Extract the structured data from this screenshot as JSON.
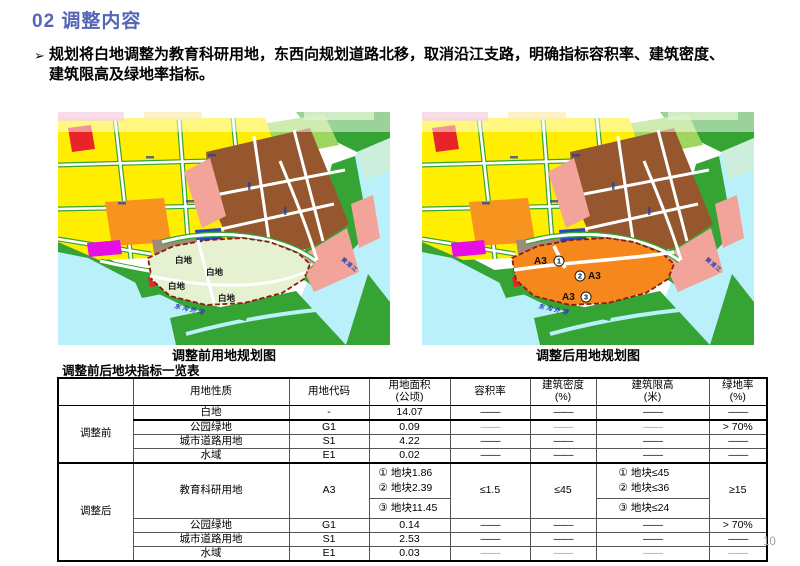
{
  "title": "02 调整内容",
  "bullet": {
    "marker": "➢",
    "lines": [
      "规划将白地调整为教育科研用地，东西向规划道路北移，取消沿江支路，明确指标容积率、建筑密度、",
      "建筑限高及绿地率指标。"
    ]
  },
  "maps": {
    "shared": {
      "river_label": "黄浦江",
      "channel_label": "东沟外港"
    },
    "before": {
      "caption": "调整前用地规划图",
      "area_labels": [
        "白地",
        "白地",
        "白地",
        "白地"
      ]
    },
    "after": {
      "caption": "调整后用地规划图",
      "labels": [
        {
          "code": "A3",
          "num": "1"
        },
        {
          "code": "A3",
          "num": "2"
        },
        {
          "code": "A3",
          "num": "3"
        }
      ]
    }
  },
  "colors": {
    "title_blue": "#5565b7",
    "plan_before_fill": "#e6f1d2",
    "plan_after_fill": "#f6871c",
    "plan_border_red": "#8f1a10",
    "water_cyan": "#b9f0f9",
    "green": "#35a435",
    "yellow": "#ffee00",
    "brown": "#96572e",
    "salmon": "#f2a49b"
  },
  "table": {
    "title": "调整前后地块指标一览表",
    "headers": [
      {
        "l1": "",
        "l2": ""
      },
      {
        "l1": "用地性质",
        "l2": ""
      },
      {
        "l1": "用地代码",
        "l2": ""
      },
      {
        "l1": "用地面积",
        "l2": "(公顷)"
      },
      {
        "l1": "容积率",
        "l2": ""
      },
      {
        "l1": "建筑密度",
        "l2": "(%)"
      },
      {
        "l1": "建筑限高",
        "l2": "(米)"
      },
      {
        "l1": "绿地率",
        "l2": "(%)"
      }
    ],
    "before": {
      "label": "调整前",
      "rows": [
        {
          "nature": "白地",
          "code": "-",
          "area": "14.07",
          "far": "——",
          "density": "——",
          "height": "——",
          "green": "——"
        },
        {
          "nature": "公园绿地",
          "code": "G1",
          "area": "0.09",
          "far": "——",
          "density": "——",
          "height": "——",
          "green": "> 70%"
        },
        {
          "nature": "城市道路用地",
          "code": "S1",
          "area": "4.22",
          "far": "——",
          "density": "——",
          "height": "——",
          "green": "——"
        },
        {
          "nature": "水域",
          "code": "E1",
          "area": "0.02",
          "far": "——",
          "density": "——",
          "height": "——",
          "green": "——"
        }
      ]
    },
    "after": {
      "label": "调整后",
      "edu": {
        "nature": "教育科研用地",
        "code": "A3",
        "areas_top": [
          "① 地块1.86",
          "② 地块2.39"
        ],
        "areas_bottom": [
          "③ 地块11.45"
        ],
        "far": "≤1.5",
        "density": "≤45",
        "heights_top": [
          "① 地块≤45",
          "② 地块≤36"
        ],
        "heights_bottom": [
          "③ 地块≤24"
        ],
        "green": "≥15"
      },
      "rows": [
        {
          "nature": "公园绿地",
          "code": "G1",
          "area": "0.14",
          "far": "——",
          "density": "——",
          "height": "——",
          "green": "> 70%"
        },
        {
          "nature": "城市道路用地",
          "code": "S1",
          "area": "2.53",
          "far": "——",
          "density": "——",
          "height": "——",
          "green": "——"
        },
        {
          "nature": "水域",
          "code": "E1",
          "area": "0.03",
          "far": "——",
          "density": "——",
          "height": "——",
          "green": "——"
        }
      ]
    }
  },
  "page_number": "10"
}
